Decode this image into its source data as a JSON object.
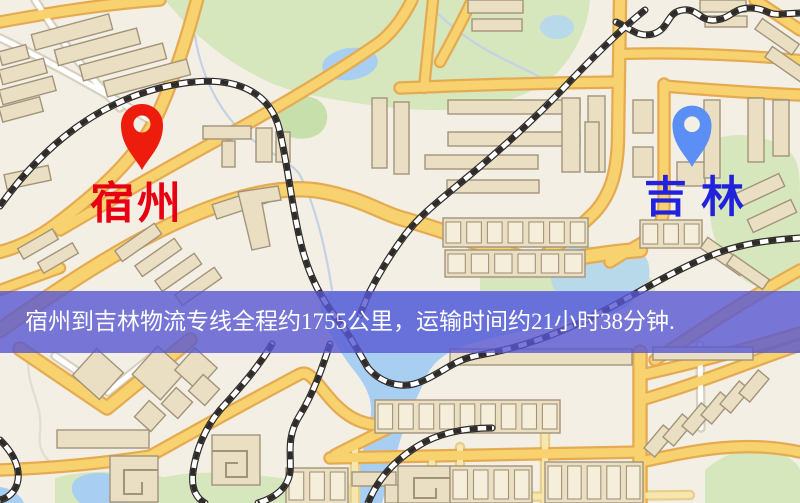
{
  "map": {
    "origin": {
      "name": "宿州",
      "pin_color": "#ee1c0d",
      "label_color": "#e60012"
    },
    "destination": {
      "name": "吉林",
      "pin_color": "#5b8ff6",
      "label_color": "#2222dd"
    }
  },
  "banner": {
    "text": "宿州到吉林物流专线全程约1755公里，运输时间约21小时38分钟.",
    "background_color": "#5858d2",
    "text_color": "#ffffff",
    "route": {
      "from": "宿州",
      "to": "吉林",
      "distance": "约1755公里",
      "duration": "约21小时38分钟"
    }
  },
  "map_colors": {
    "background": "#f4efe5",
    "road_fill": "#f8d26e",
    "road_casing": "#e5ab52",
    "minor_road": "#f7e7ae",
    "white_road": "#ffffff",
    "water": "#a8cff2",
    "park": "#d6e7bd",
    "building_fill": "#ebdfc3",
    "building_stroke": "#a2947a",
    "railway": "#2e2b28"
  }
}
